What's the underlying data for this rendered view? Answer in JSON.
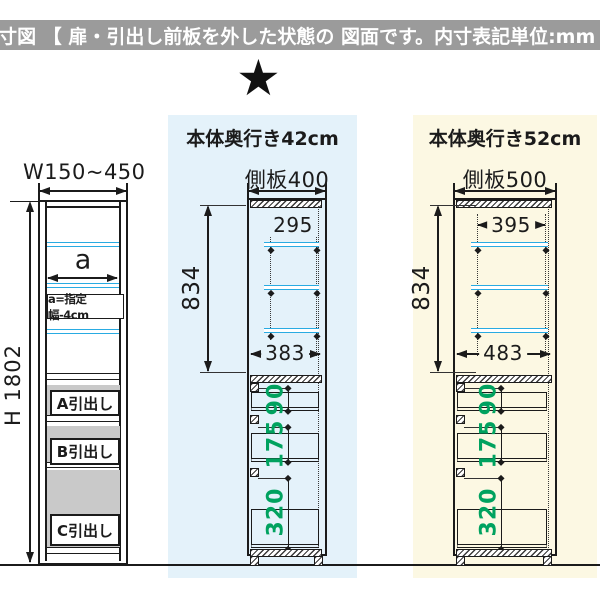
{
  "header": {
    "text": "内寸図 【 扉・引出し前板を外した状態の 図面です。内寸表記単位:mm 】"
  },
  "star": {
    "glyph": "★"
  },
  "left_cabinet": {
    "width_label": "W150~450",
    "height_label": "H 1802",
    "inner_width_label": "a",
    "inner_width_note": "a=指定幅-4cm",
    "drawers": [
      {
        "label": "A引出し"
      },
      {
        "label": "B引出し"
      },
      {
        "label": "C引出し"
      }
    ]
  },
  "middle_panel": {
    "title": "本体奥行き42cm",
    "side_panel_label": "側板400",
    "inner_height": "834",
    "shelf_depth": "295",
    "inner_depth": "383",
    "drawer_heights": [
      "90",
      "175",
      "320"
    ]
  },
  "right_panel": {
    "title": "本体奥行き52cm",
    "side_panel_label": "側板500",
    "inner_height": "834",
    "shelf_depth": "395",
    "inner_depth": "483",
    "drawer_heights": [
      "90",
      "175",
      "320"
    ]
  },
  "colors": {
    "header_bar": "#9b9b9b",
    "panel_blue": "#e4f2fa",
    "panel_yellow": "#fcf8e3",
    "shelf_cyan": "#29abe2",
    "dimension_green": "#00a25f",
    "drawer_gray": "#c9c9c9",
    "line": "#1b1b1b"
  }
}
